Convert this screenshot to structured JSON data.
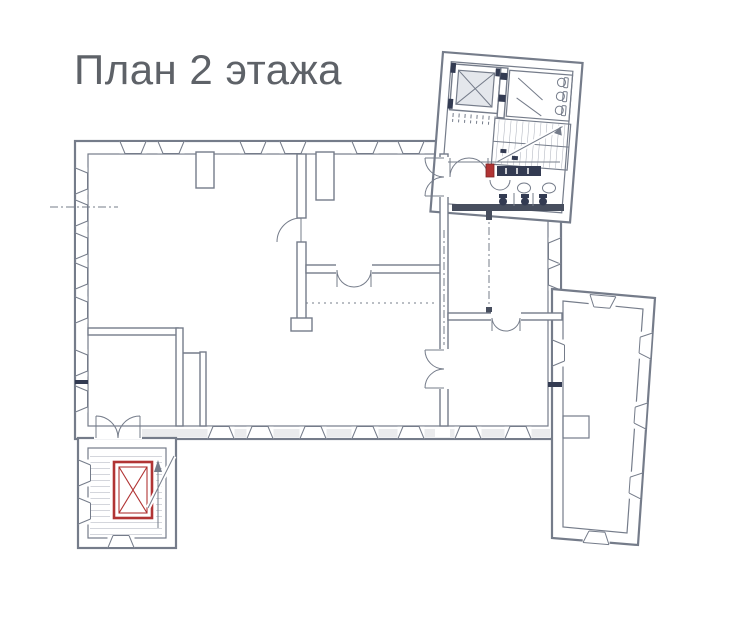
{
  "header": {
    "title": "План 2 этажа",
    "title_color": "#5e6268"
  },
  "plan": {
    "type": "floor-plan",
    "colors": {
      "title": "#5e6268",
      "line": "#757c8a",
      "line_dark": "#474e5e",
      "navy": "#333b52",
      "red": "#b13434",
      "red_dark": "#7e2424",
      "wall_fill": "#d9dbdf",
      "tread": "#a8adb8"
    },
    "features": [
      "main-building-block",
      "north-annex-with-elevator-and-wc",
      "upper-staircase",
      "lower-staircase-with-red-elevator",
      "right-wing",
      "windows",
      "door-swings",
      "toilets",
      "sinks"
    ]
  }
}
